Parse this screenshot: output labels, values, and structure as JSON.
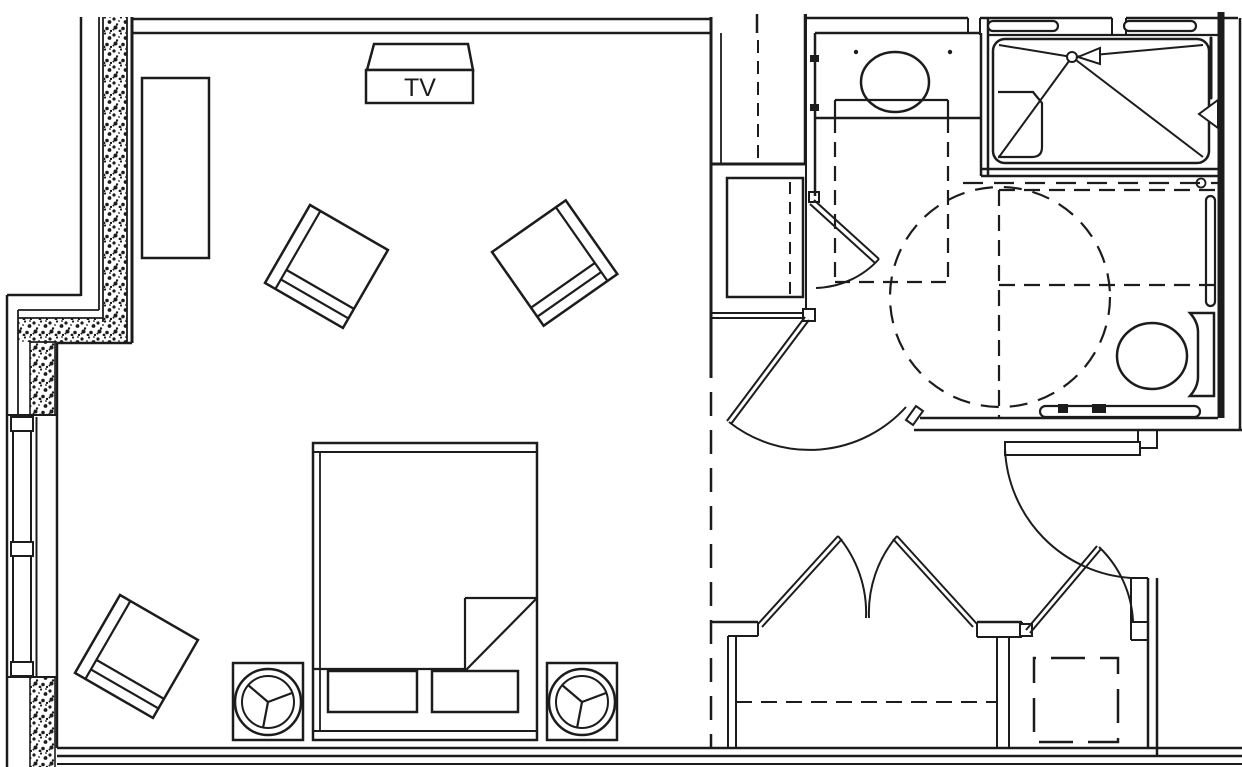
{
  "title": "Accessible guest room floor plan",
  "canvas": {
    "width": 1242,
    "height": 767
  },
  "palette": {
    "line": "#1c1c1c",
    "background": "#ffffff"
  },
  "labels": {
    "tv": "TV"
  },
  "rooms": [
    {
      "name": "bedroom"
    },
    {
      "name": "bathroom"
    },
    {
      "name": "entry-foyer"
    },
    {
      "name": "closet"
    },
    {
      "name": "alcove"
    }
  ],
  "furniture": [
    {
      "name": "tv-console"
    },
    {
      "name": "dresser"
    },
    {
      "name": "lounge-chair",
      "count": 3
    },
    {
      "name": "bed-with-pillows-and-folded-corner"
    },
    {
      "name": "nightstand-with-lamp",
      "count": 2
    }
  ],
  "fixtures": [
    {
      "name": "window-with-mullions"
    },
    {
      "name": "vanity-counter-with-oval-sink"
    },
    {
      "name": "roll-in-shower-with-seat-and-drain"
    },
    {
      "name": "shower-head"
    },
    {
      "name": "toilet-with-tank"
    },
    {
      "name": "grab-bar",
      "count": 4
    },
    {
      "name": "wardrobe-closet-with-rod"
    },
    {
      "name": "minibar-cabinet"
    },
    {
      "name": "double-door-closet"
    },
    {
      "name": "entry-door"
    },
    {
      "name": "bathroom-corner-door"
    }
  ],
  "annotations": [
    {
      "name": "wheelchair-turning-circle",
      "style": "dashed-circle"
    },
    {
      "name": "clear-floor-space-vanity",
      "style": "dashed-rect"
    },
    {
      "name": "clear-floor-space-toilet",
      "style": "dashed-lines"
    },
    {
      "name": "closet-rod",
      "style": "dashed-line"
    },
    {
      "name": "room-divider-overhead",
      "style": "dashed-line"
    },
    {
      "name": "shower-curtain",
      "style": "dashed-line"
    }
  ]
}
